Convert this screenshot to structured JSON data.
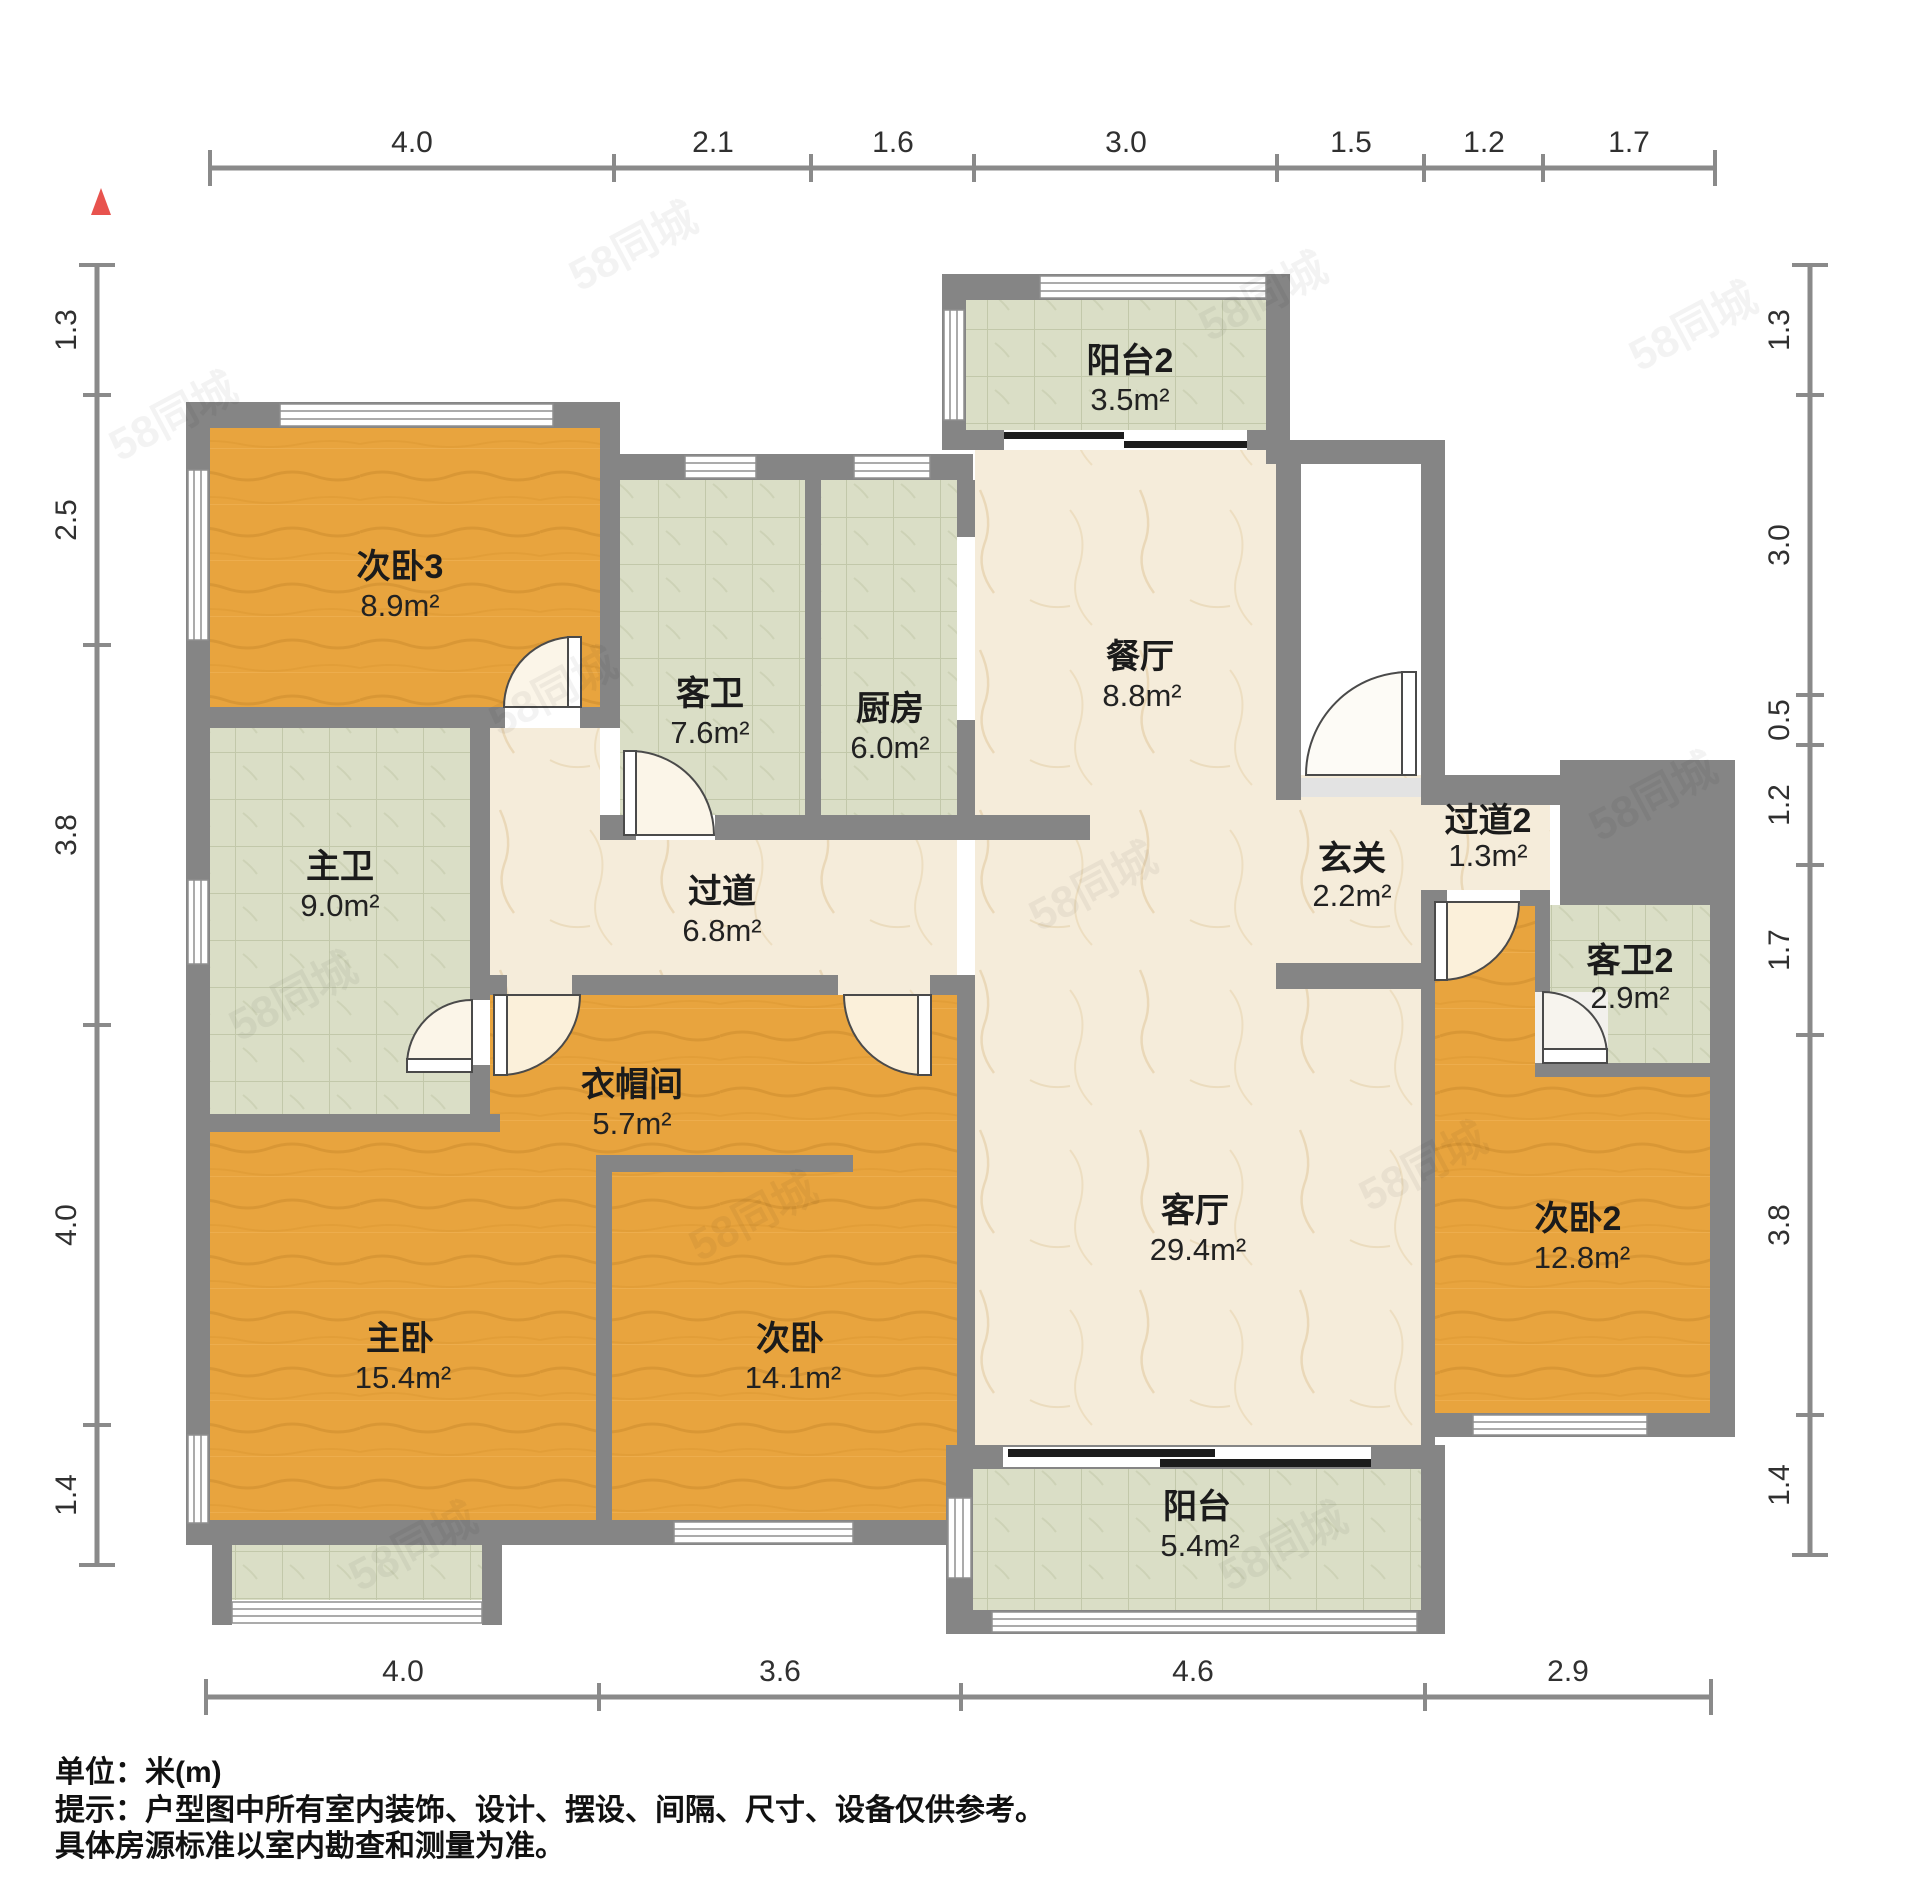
{
  "plan": {
    "type": "residential-floor-plan",
    "unit_note": "单位：米(m)",
    "watermark": {
      "text": "58同城"
    },
    "north_indicator": {
      "shape": "triangle",
      "color": "#e8534e"
    }
  },
  "rooms": [
    {
      "name": "次卧3",
      "area": "8.9m²",
      "floor": "wood"
    },
    {
      "name": "客卫",
      "area": "7.6m²",
      "floor": "tile"
    },
    {
      "name": "厨房",
      "area": "6.0m²",
      "floor": "tile"
    },
    {
      "name": "餐厅",
      "area": "8.8m²",
      "floor": "marble"
    },
    {
      "name": "阳台2",
      "area": "3.5m²",
      "floor": "tile"
    },
    {
      "name": "主卫",
      "area": "9.0m²",
      "floor": "tile"
    },
    {
      "name": "过道",
      "area": "6.8m²",
      "floor": "marble"
    },
    {
      "name": "玄关",
      "area": "2.2m²",
      "floor": "marble"
    },
    {
      "name": "过道2",
      "area": "1.3m²",
      "floor": "marble"
    },
    {
      "name": "客卫2",
      "area": "2.9m²",
      "floor": "tile"
    },
    {
      "name": "衣帽间",
      "area": "5.7m²",
      "floor": "wood"
    },
    {
      "name": "主卧",
      "area": "15.4m²",
      "floor": "wood"
    },
    {
      "name": "次卧",
      "area": "14.1m²",
      "floor": "wood"
    },
    {
      "name": "客厅",
      "area": "29.4m²",
      "floor": "marble"
    },
    {
      "name": "次卧2",
      "area": "12.8m²",
      "floor": "wood"
    },
    {
      "name": "阳台",
      "area": "5.4m²",
      "floor": "tile"
    }
  ],
  "dims": {
    "unit": "m",
    "top": {
      "values": [
        "4.0",
        "2.1",
        "1.6",
        "3.0",
        "1.5",
        "1.2",
        "1.7"
      ]
    },
    "bottom": {
      "values": [
        "4.0",
        "3.6",
        "4.6",
        "2.9"
      ]
    },
    "left": {
      "values": [
        "1.3",
        "2.5",
        "3.8",
        "4.0",
        "1.4"
      ]
    },
    "right": {
      "values": [
        "1.3",
        "3.0",
        "0.5",
        "1.2",
        "1.7",
        "3.8",
        "1.4"
      ]
    }
  },
  "notes": {
    "line1": "单位：米(m)",
    "line2": "提示：户型图中所有室内装饰、设计、摆设、间隔、尺寸、设备仅供参考。",
    "line3": "具体房源标准以室内勘查和测量为准。"
  },
  "colors": {
    "wall": "#858585",
    "wood_floor": "#e8a43e",
    "tile_floor": "#dadec6",
    "marble_floor": "#f5ecda",
    "dimension_line": "#8a8a8a",
    "north_arrow": "#e8534e"
  }
}
